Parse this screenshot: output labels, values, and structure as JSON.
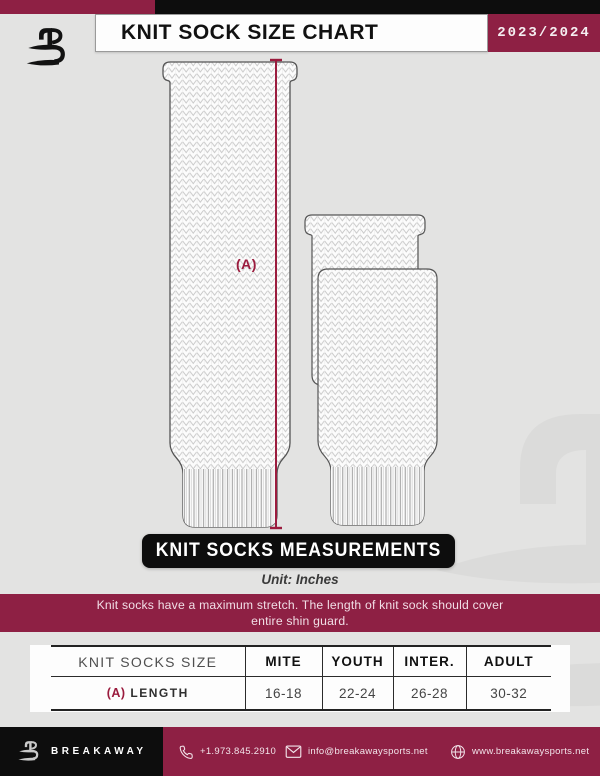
{
  "theme": {
    "accent": "#8e2044",
    "black": "#0d0d0d",
    "page_bg": "#e3e3e2",
    "measure_line_color": "#9b1c3e"
  },
  "header": {
    "title": "KNIT SOCK SIZE CHART",
    "season": "2023/2024"
  },
  "diagram": {
    "measurement_label": "(A)"
  },
  "measurements": {
    "banner": "KNIT SOCKS MEASUREMENTS",
    "unit_label": "Unit: Inches",
    "note_line1": "Knit socks have a maximum stretch. The length of knit sock should cover",
    "note_line2": "entire shin guard."
  },
  "table": {
    "headers": [
      "KNIT SOCKS SIZE",
      "MITE",
      "YOUTH",
      "INTER.",
      "ADULT"
    ],
    "rows": [
      {
        "label_prefix": "(A)",
        "label": "LENGTH",
        "values": [
          "16-18",
          "22-24",
          "26-28",
          "30-32"
        ]
      }
    ]
  },
  "footer": {
    "brand": "BREAKAWAY",
    "phone": "+1.973.845.2910",
    "email": "info@breakawaysports.net",
    "website": "www.breakawaysports.net"
  }
}
